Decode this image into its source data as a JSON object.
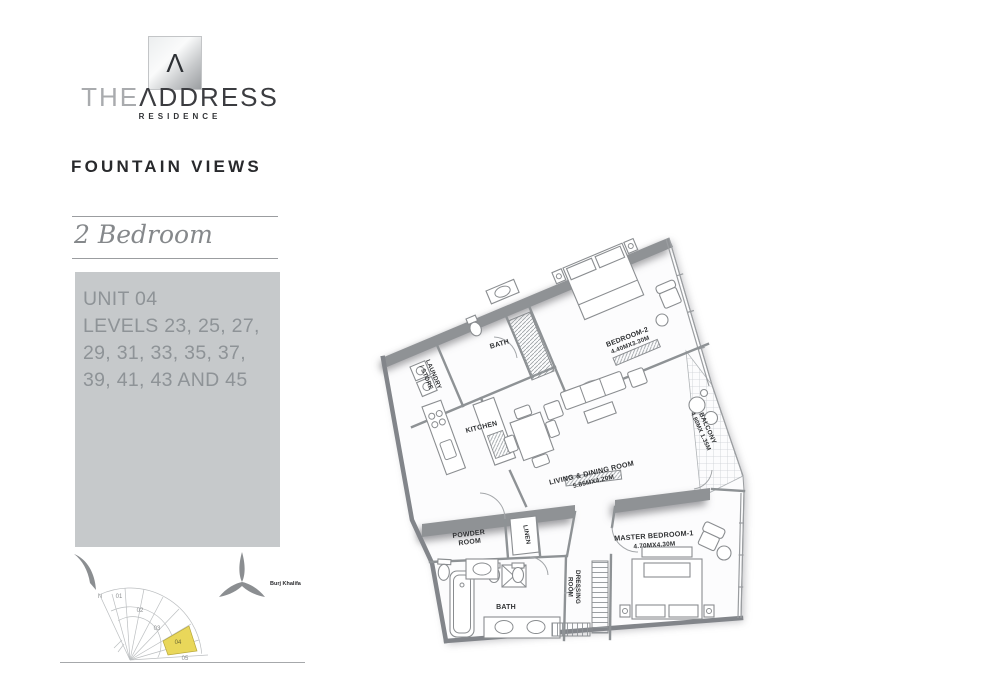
{
  "brand": {
    "logo_glyph": "Λ",
    "the": "THE",
    "address": "ΛDDRESS",
    "residence": "RESIDENCE"
  },
  "project": {
    "name": "FOUNTAIN VIEWS",
    "unit_type": "2 Bedroom"
  },
  "unit_info": {
    "line1": "UNIT 04",
    "line2": "LEVELS 23, 25, 27,",
    "line3": "29, 31, 33, 35, 37,",
    "line4": "39, 41, 43 AND 45"
  },
  "key_plan": {
    "north": "N",
    "u1": "01",
    "u2": "02",
    "u3": "03",
    "u4": "04",
    "u5": "05",
    "highlighted_unit": "04",
    "highlight_color": "#e9d75a",
    "landmark": "Burj Khalifa"
  },
  "floor_plan": {
    "laundry_line1": "LAUNDRY",
    "laundry_line2": "/ STORE",
    "bath_top": "BATH",
    "kitchen": "KITCHEN",
    "bedroom2": "BEDROOM-2",
    "bedroom2_dim": "4.40MX3.30M",
    "living": "LIVING & DINING ROOM",
    "living_dim": "5.85MX4.20M",
    "balcony": "BALCONY",
    "balcony_dim": "4.80MX 1.35M",
    "powder_line1": "POWDER",
    "powder_line2": "ROOM",
    "linen": "LINEN",
    "master": "MASTER BEDROOM-1",
    "master_dim": "4.70MX4.30M",
    "dressing_line1": "DRESSING",
    "dressing_line2": "ROOM",
    "bath_bottom": "BATH"
  },
  "colors": {
    "info_box_bg": "#c6c9cb",
    "wall_gray": "#8f9295",
    "highlight_yellow": "#e9d75a"
  }
}
